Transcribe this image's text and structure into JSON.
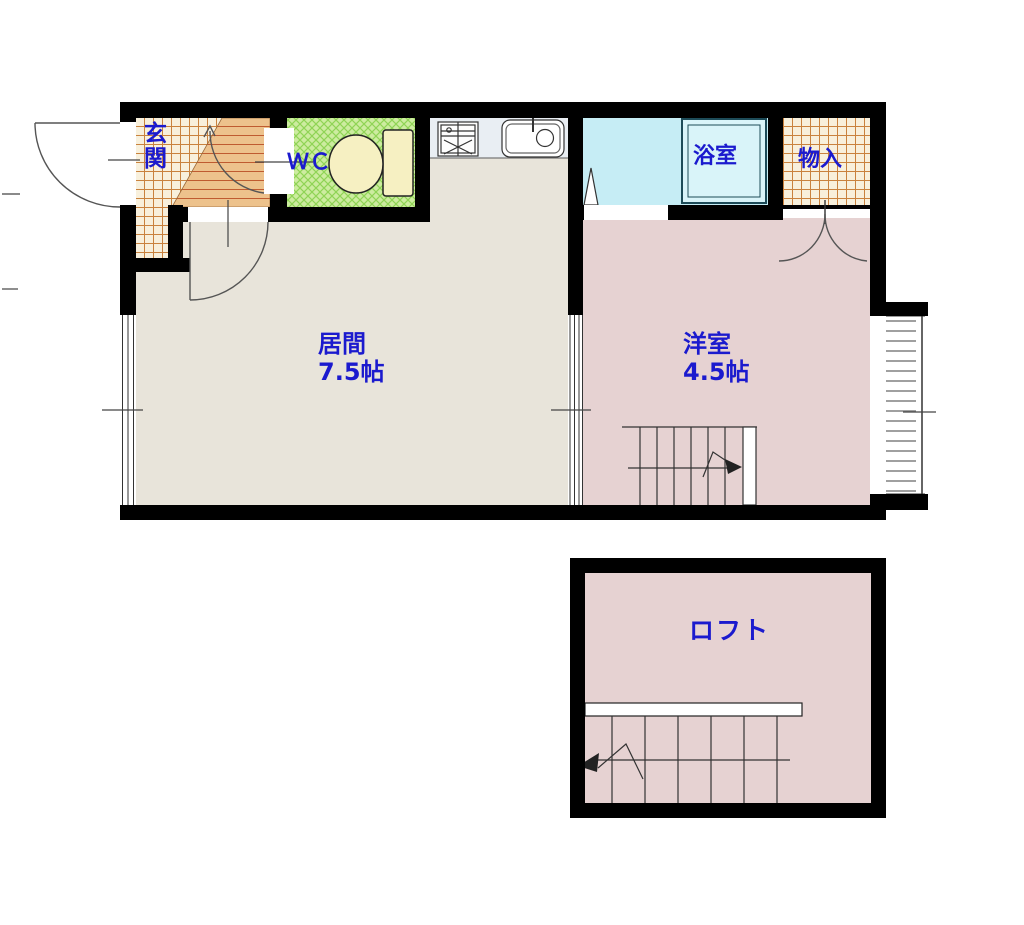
{
  "floorplan": {
    "rooms": {
      "genkan": {
        "label": "玄関"
      },
      "wc": {
        "label": "ＷＣ"
      },
      "living": {
        "label": "居間",
        "area": "7.5帖"
      },
      "bath": {
        "label": "浴室"
      },
      "storage": {
        "label": "物入"
      },
      "western": {
        "label": "洋室",
        "area": "4.5帖"
      },
      "loft": {
        "label": "ロフト"
      }
    },
    "colors": {
      "wall": "#000000",
      "living_floor": "#e8e4da",
      "tatami_pink_floor": "#e6d2d2",
      "bath_floor": "#c6edf5",
      "bathtub": "#d9f4f9",
      "wc_floor_base": "#cdeca0",
      "wc_floor_line": "#8fd455",
      "entry_tile_base": "#f8f0dc",
      "entry_tile_line": "#c9823e",
      "step_plank_base": "#edc28c",
      "step_plank_line": "#bf5b30",
      "kitchen_counter": "#e9eef3",
      "fixture_cream": "#f6f0c2",
      "label_text": "#1b1ace",
      "thin_line": "#444444"
    }
  }
}
